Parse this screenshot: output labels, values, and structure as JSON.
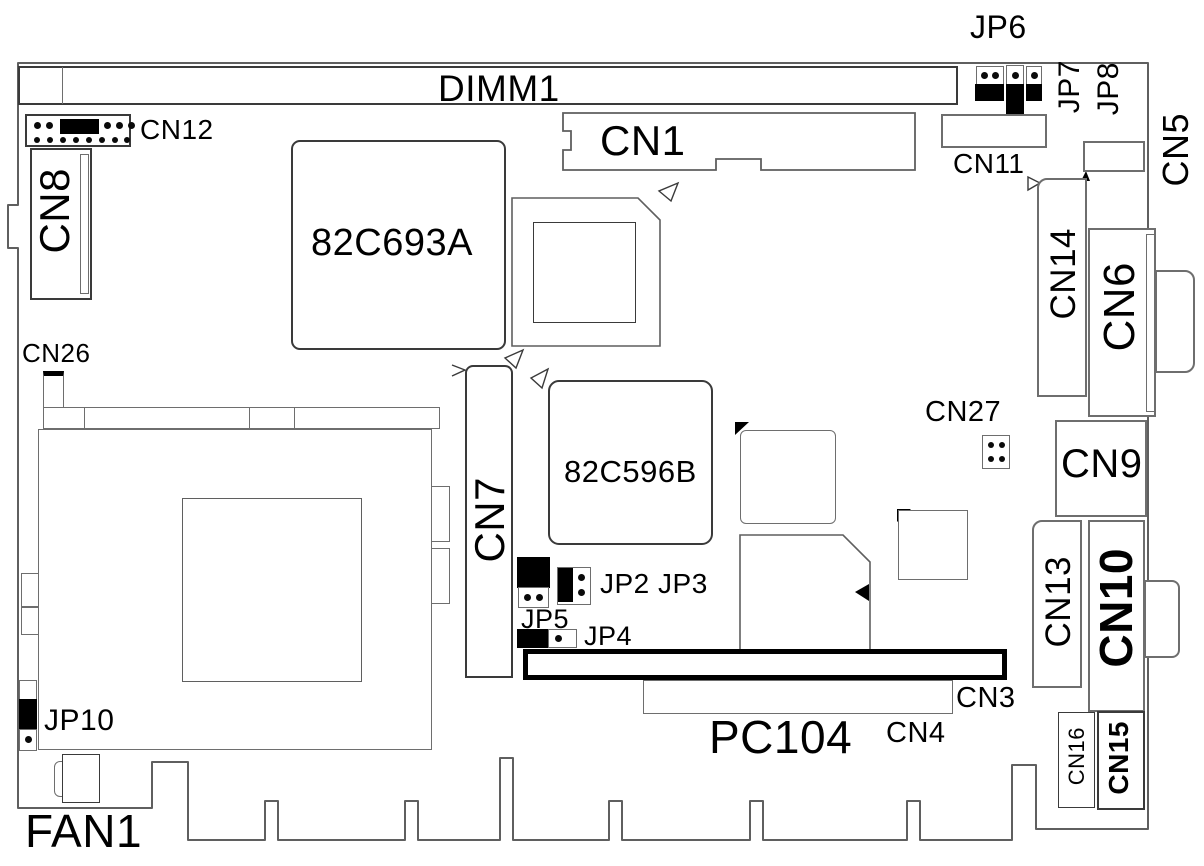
{
  "diagram": {
    "type": "motherboard-component-layout",
    "description": "single board computer silkscreen layout diagram"
  },
  "labels": {
    "jp6": "JP6",
    "jp7": "JP7",
    "jp8": "JP8",
    "cn5": "CN5",
    "dimm1": "DIMM1",
    "cn1": "CN1",
    "cn11": "CN11",
    "cn12": "CN12",
    "cn8": "CN8",
    "chip_82c693a": "82C693A",
    "cn14": "CN14",
    "cn6": "CN6",
    "cn26": "CN26",
    "chip_82c596b": "82C596B",
    "cn7": "CN7",
    "cn27": "CN27",
    "cn9": "CN9",
    "jp2_jp3": "JP2 JP3",
    "jp5": "JP5",
    "jp4": "JP4",
    "cn13": "CN13",
    "cn10": "CN10",
    "cn3": "CN3",
    "cn4": "CN4",
    "pc104": "PC104",
    "jp10": "JP10",
    "cn16": "CN16",
    "cn15": "CN15",
    "fan1": "FAN1"
  },
  "colors": {
    "background": "#ffffff",
    "line_light": "#6e6e6e",
    "line_dark": "#000000",
    "jumper_fill": "#000000",
    "text": "#000000"
  }
}
